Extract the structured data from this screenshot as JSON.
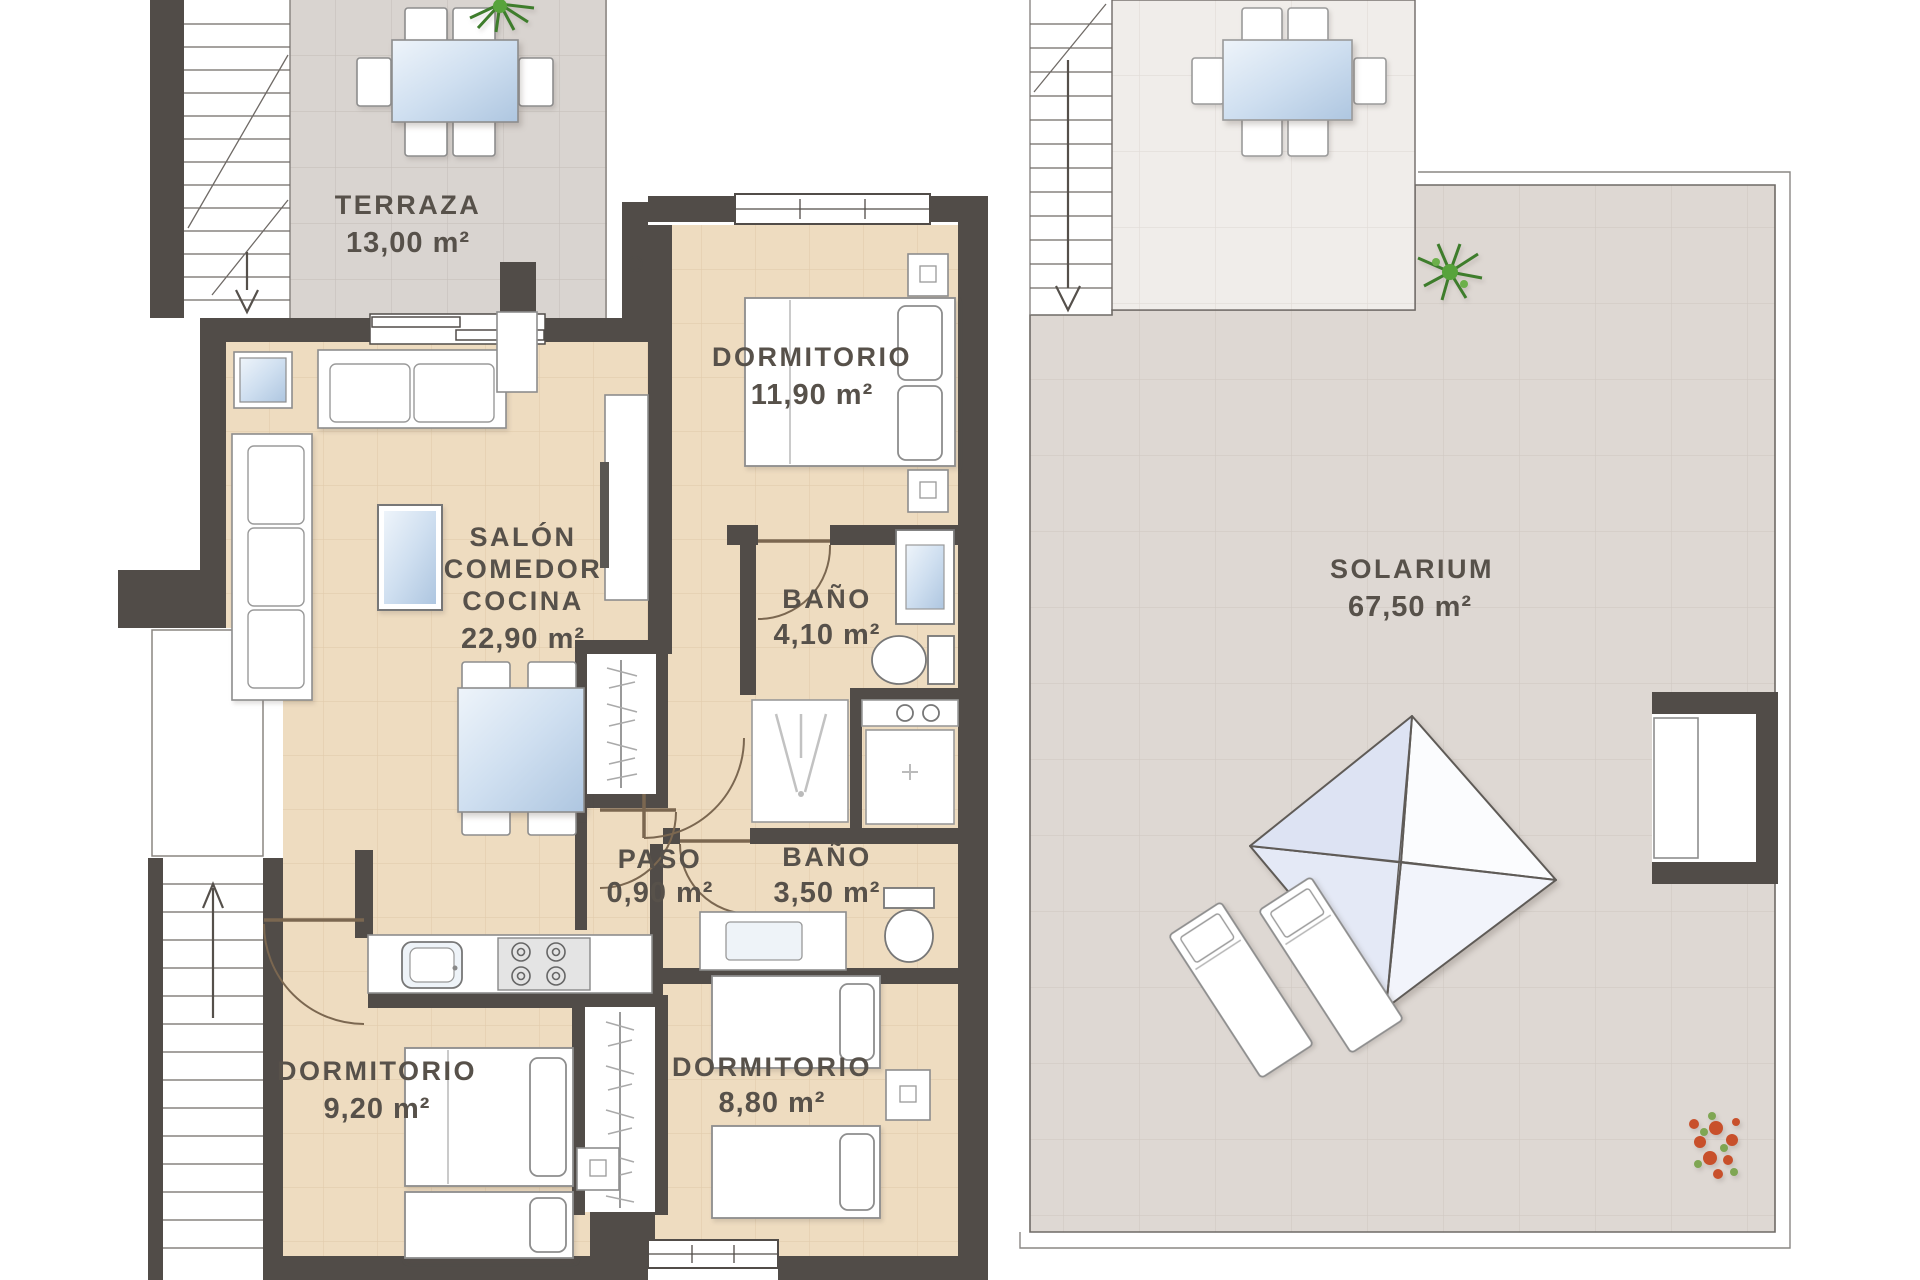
{
  "plan": {
    "type": "floor-plan",
    "language": "es",
    "colors": {
      "wall": "#514c48",
      "floor_interior": "#eedcc0",
      "floor_terrace": "#d9d4d0",
      "floor_solarium": "#ded8d3",
      "floor_covered": "#f0edea",
      "label_text": "#57514a",
      "glass": "#bcd0e6",
      "plant_green": "#4c8d33",
      "plant_red": "#c8502b",
      "furniture": "#ffffff"
    },
    "rooms": [
      {
        "id": "terraza",
        "name": "TERRAZA",
        "area": "13,00 m²"
      },
      {
        "id": "salon",
        "name": "SALÓN COMEDOR COCINA",
        "name_lines": [
          "SALÓN",
          "COMEDOR",
          "COCINA"
        ],
        "area": "22,90 m²"
      },
      {
        "id": "dormitorio-1",
        "name": "DORMITORIO",
        "area": "11,90 m²"
      },
      {
        "id": "bano-1",
        "name": "BAÑO",
        "area": "4,10 m²"
      },
      {
        "id": "paso",
        "name": "PASO",
        "area": "0,90 m²"
      },
      {
        "id": "bano-2",
        "name": "BAÑO",
        "area": "3,50 m²"
      },
      {
        "id": "dormitorio-2",
        "name": "DORMITORIO",
        "area": "9,20 m²"
      },
      {
        "id": "dormitorio-3",
        "name": "DORMITORIO",
        "area": "8,80 m²"
      },
      {
        "id": "solarium",
        "name": "SOLARIUM",
        "area": "67,50 m²"
      }
    ]
  }
}
